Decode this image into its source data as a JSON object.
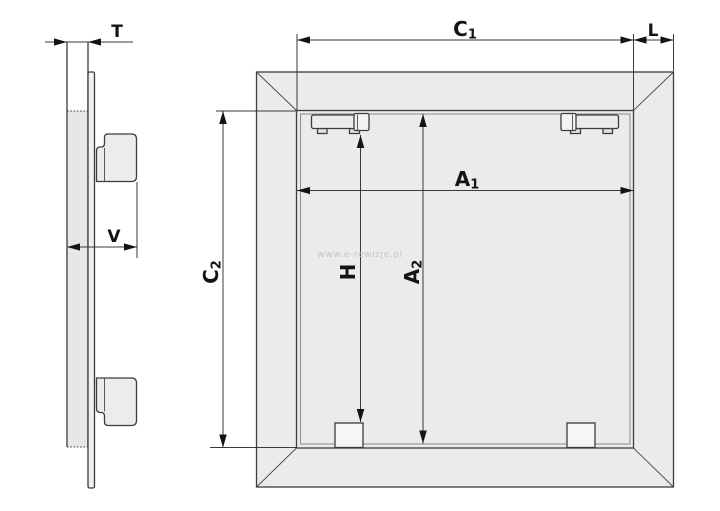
{
  "colors": {
    "background": "#ffffff",
    "line": "#3c3c3c",
    "label": "#141414",
    "frame_fill": "#ebebeb",
    "wall_fill": "#e7e7e7",
    "watermark": "#c6c5c2"
  },
  "watermark": {
    "text": "www.e-rewizje.pl"
  },
  "side_view": {
    "dim_t": {
      "label": "T"
    },
    "dim_v": {
      "label": "V"
    }
  },
  "front_view": {
    "dim_c1": {
      "base": "C",
      "sub": "1"
    },
    "dim_l": {
      "label": "L"
    },
    "dim_c2": {
      "base": "C",
      "sub": "2"
    },
    "dim_a1": {
      "base": "A",
      "sub": "1"
    },
    "dim_a2": {
      "base": "A",
      "sub": "2"
    },
    "dim_h": {
      "label": "H"
    }
  }
}
